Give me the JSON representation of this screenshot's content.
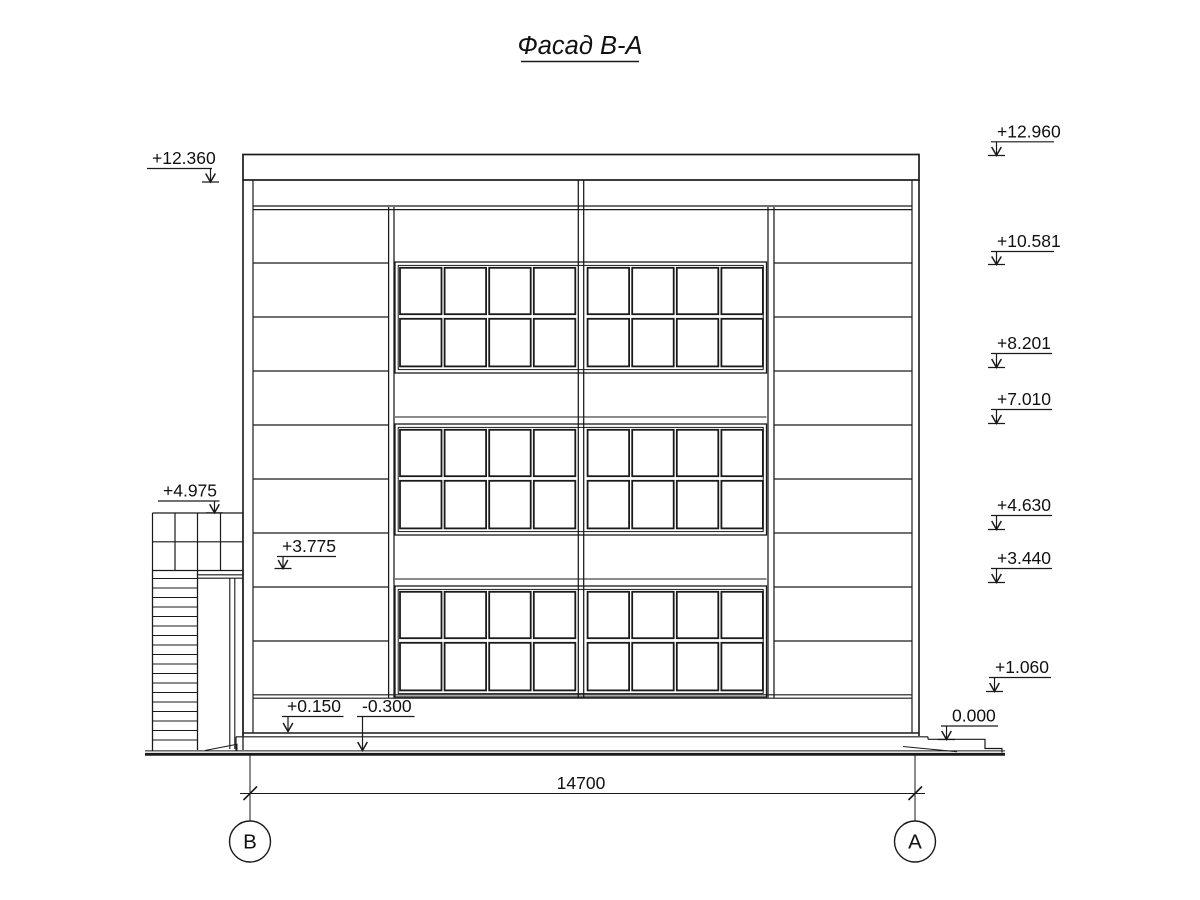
{
  "title": "Фасад В-А",
  "dimension": {
    "value": "14700"
  },
  "axes": [
    {
      "label": "В"
    },
    {
      "label": "А"
    }
  ],
  "marks": {
    "left": [
      {
        "label": "+12.360"
      },
      {
        "label": "+4.975"
      },
      {
        "label": "+3.775"
      },
      {
        "label": "+0.150"
      },
      {
        "label": "-0.300"
      }
    ],
    "right": [
      {
        "label": "+12.960"
      },
      {
        "label": "+10.581"
      },
      {
        "label": "+8.201"
      },
      {
        "label": "+7.010"
      },
      {
        "label": "+4.630"
      },
      {
        "label": "+3.440"
      },
      {
        "label": "+1.060"
      },
      {
        "label": "0.000"
      }
    ]
  },
  "colors": {
    "line": "#1a1a1a",
    "background": "#ffffff"
  }
}
